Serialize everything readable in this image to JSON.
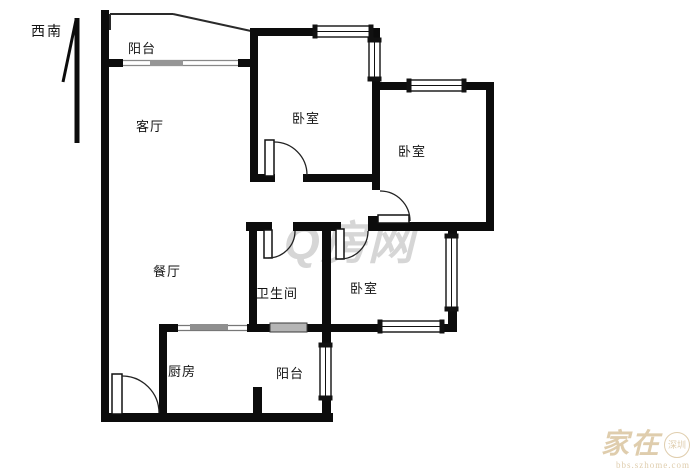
{
  "compass": {
    "label": "西南"
  },
  "rooms": [
    {
      "id": "balcony-top",
      "name": "阳台"
    },
    {
      "id": "living-room",
      "name": "客厅"
    },
    {
      "id": "bedroom-1",
      "name": "卧室"
    },
    {
      "id": "bedroom-2",
      "name": "卧室"
    },
    {
      "id": "dining-room",
      "name": "餐厅"
    },
    {
      "id": "bathroom",
      "name": "卫生间"
    },
    {
      "id": "bedroom-3",
      "name": "卧室"
    },
    {
      "id": "kitchen",
      "name": "厨房"
    },
    {
      "id": "balcony-bottom",
      "name": "阳台"
    }
  ],
  "watermarks": {
    "center": "Q房网",
    "corner_main": "家在",
    "corner_badge": "深圳",
    "corner_sub": "bbs.szhome.com"
  },
  "colors": {
    "wall": "#0c0c0c",
    "thin_line": "#2a2a2a",
    "grey_bar": "#969696",
    "vent_fill": "#b5b5b5",
    "watermark_center": "rgba(130,130,130,0.33)",
    "watermark_corner": "rgba(196,164,105,0.55)"
  }
}
